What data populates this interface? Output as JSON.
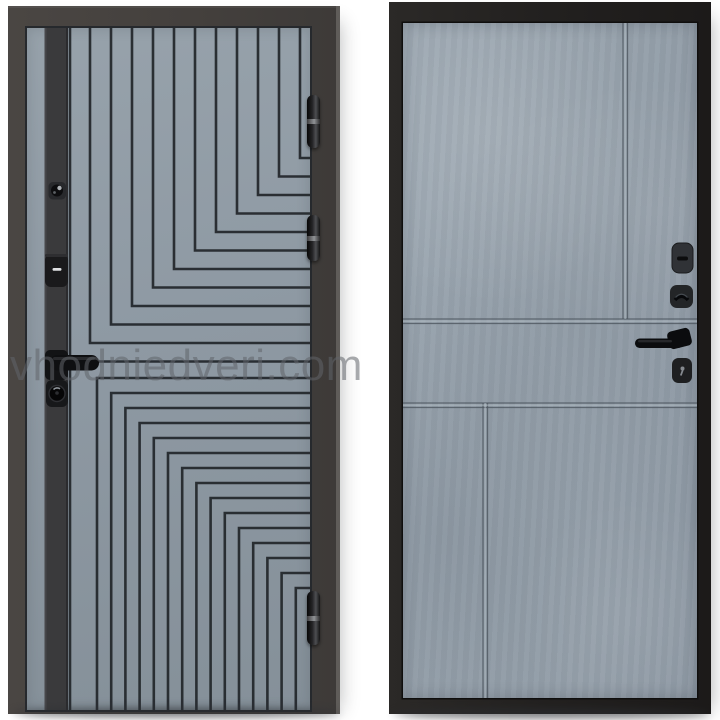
{
  "watermark": {
    "text": "vhodniedveri.com"
  },
  "colors": {
    "background": "#ffffff",
    "left_door_frame": "#44403d",
    "left_door_panel": "#8e99a3",
    "left_door_pattern_line": "#23272c",
    "left_door_stripe": "#3a3a3c",
    "right_door_frame": "#22201f",
    "right_door_panel": "#96a1ab",
    "right_door_groove": "#4e565f",
    "hardware_black": "#121315",
    "watermark_color": "#60656a"
  }
}
